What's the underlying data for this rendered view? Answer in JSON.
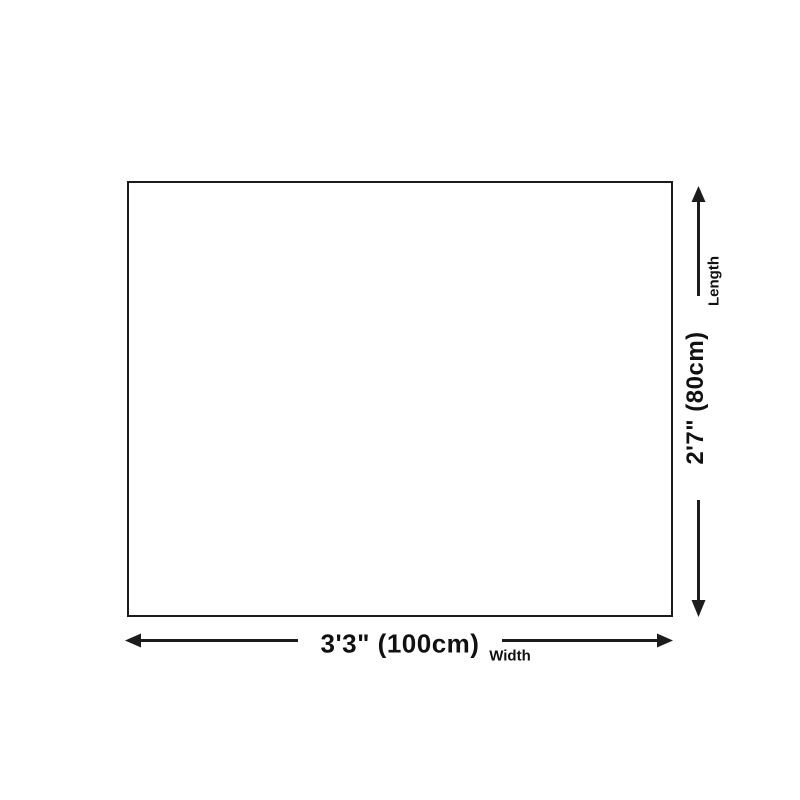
{
  "diagram": {
    "type": "product-size-diagram",
    "background_color": "#ffffff",
    "line_color": "#1c1c1c",
    "text_color": "#111111",
    "shape": "rectangle",
    "width_dimension": {
      "value": "3'3\" (100cm)",
      "axis_label": "Width"
    },
    "length_dimension": {
      "value": "2'7\" (80cm)",
      "axis_label": "Length"
    }
  }
}
